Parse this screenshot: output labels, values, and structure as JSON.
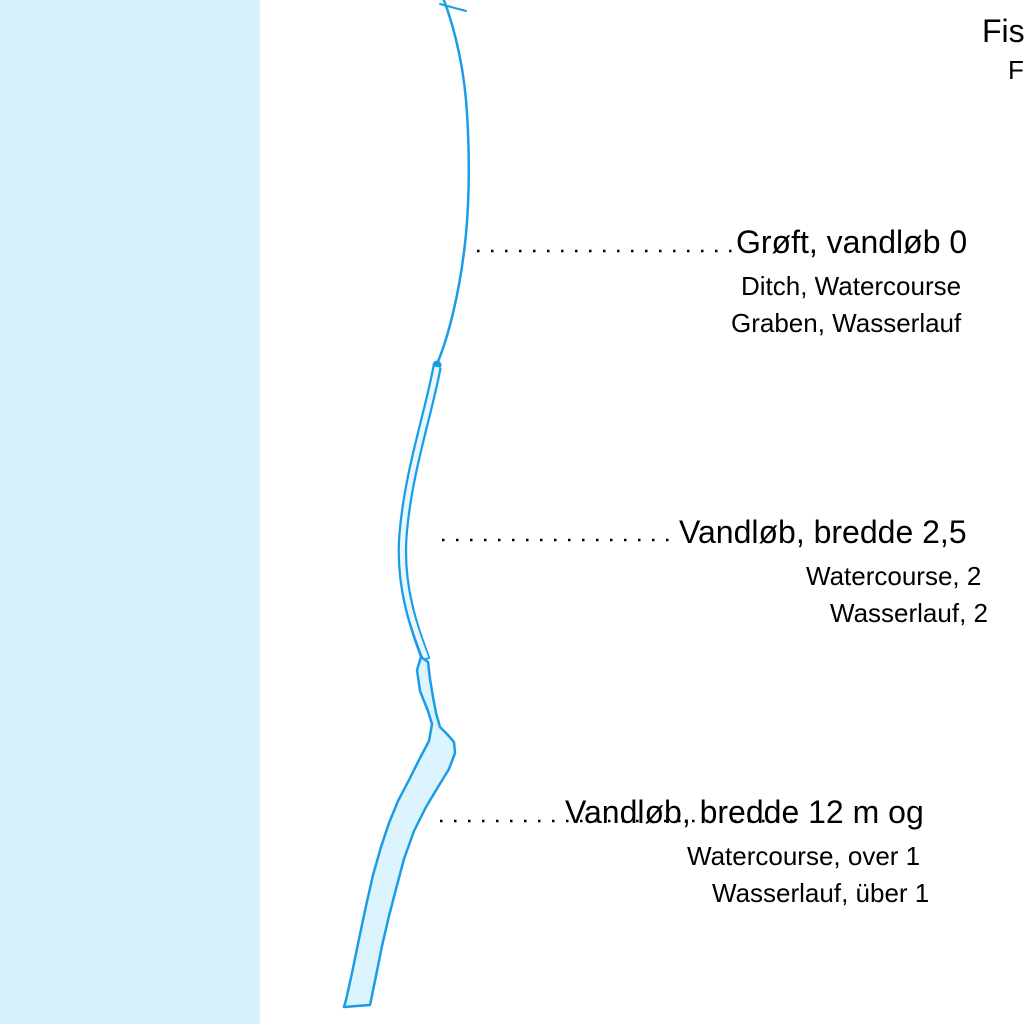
{
  "canvas": {
    "width": 1024,
    "height": 1024,
    "background": "#ffffff"
  },
  "water_panel": {
    "color": "#d6f1fc"
  },
  "symbols": {
    "line_color": "#1b9ce7",
    "area_fill": "#dcf4fd",
    "stream_inner_fill": "#e8f7fe",
    "leader_dot_color": "#000000",
    "names": {
      "ditch": "single-line-watercourse-symbol",
      "medium": "double-line-watercourse-symbol",
      "wide": "filled-area-watercourse-symbol"
    }
  },
  "legend_entries": [
    {
      "id": "ditch",
      "da": "Grøft, vandløb 0",
      "en": "Ditch, Watercourse",
      "de": "Graben, Wasserlauf"
    },
    {
      "id": "watercourse-medium",
      "da": "Vandløb, bredde 2,5",
      "en": "Watercourse, 2",
      "de": "Wasserlauf, 2"
    },
    {
      "id": "watercourse-wide",
      "da": "Vandløb, bredde 12 m og",
      "en": "Watercourse, over 1",
      "de": "Wasserlauf, über 1"
    }
  ],
  "partial_entry_top_right": {
    "da": "Fis",
    "en": "F"
  }
}
